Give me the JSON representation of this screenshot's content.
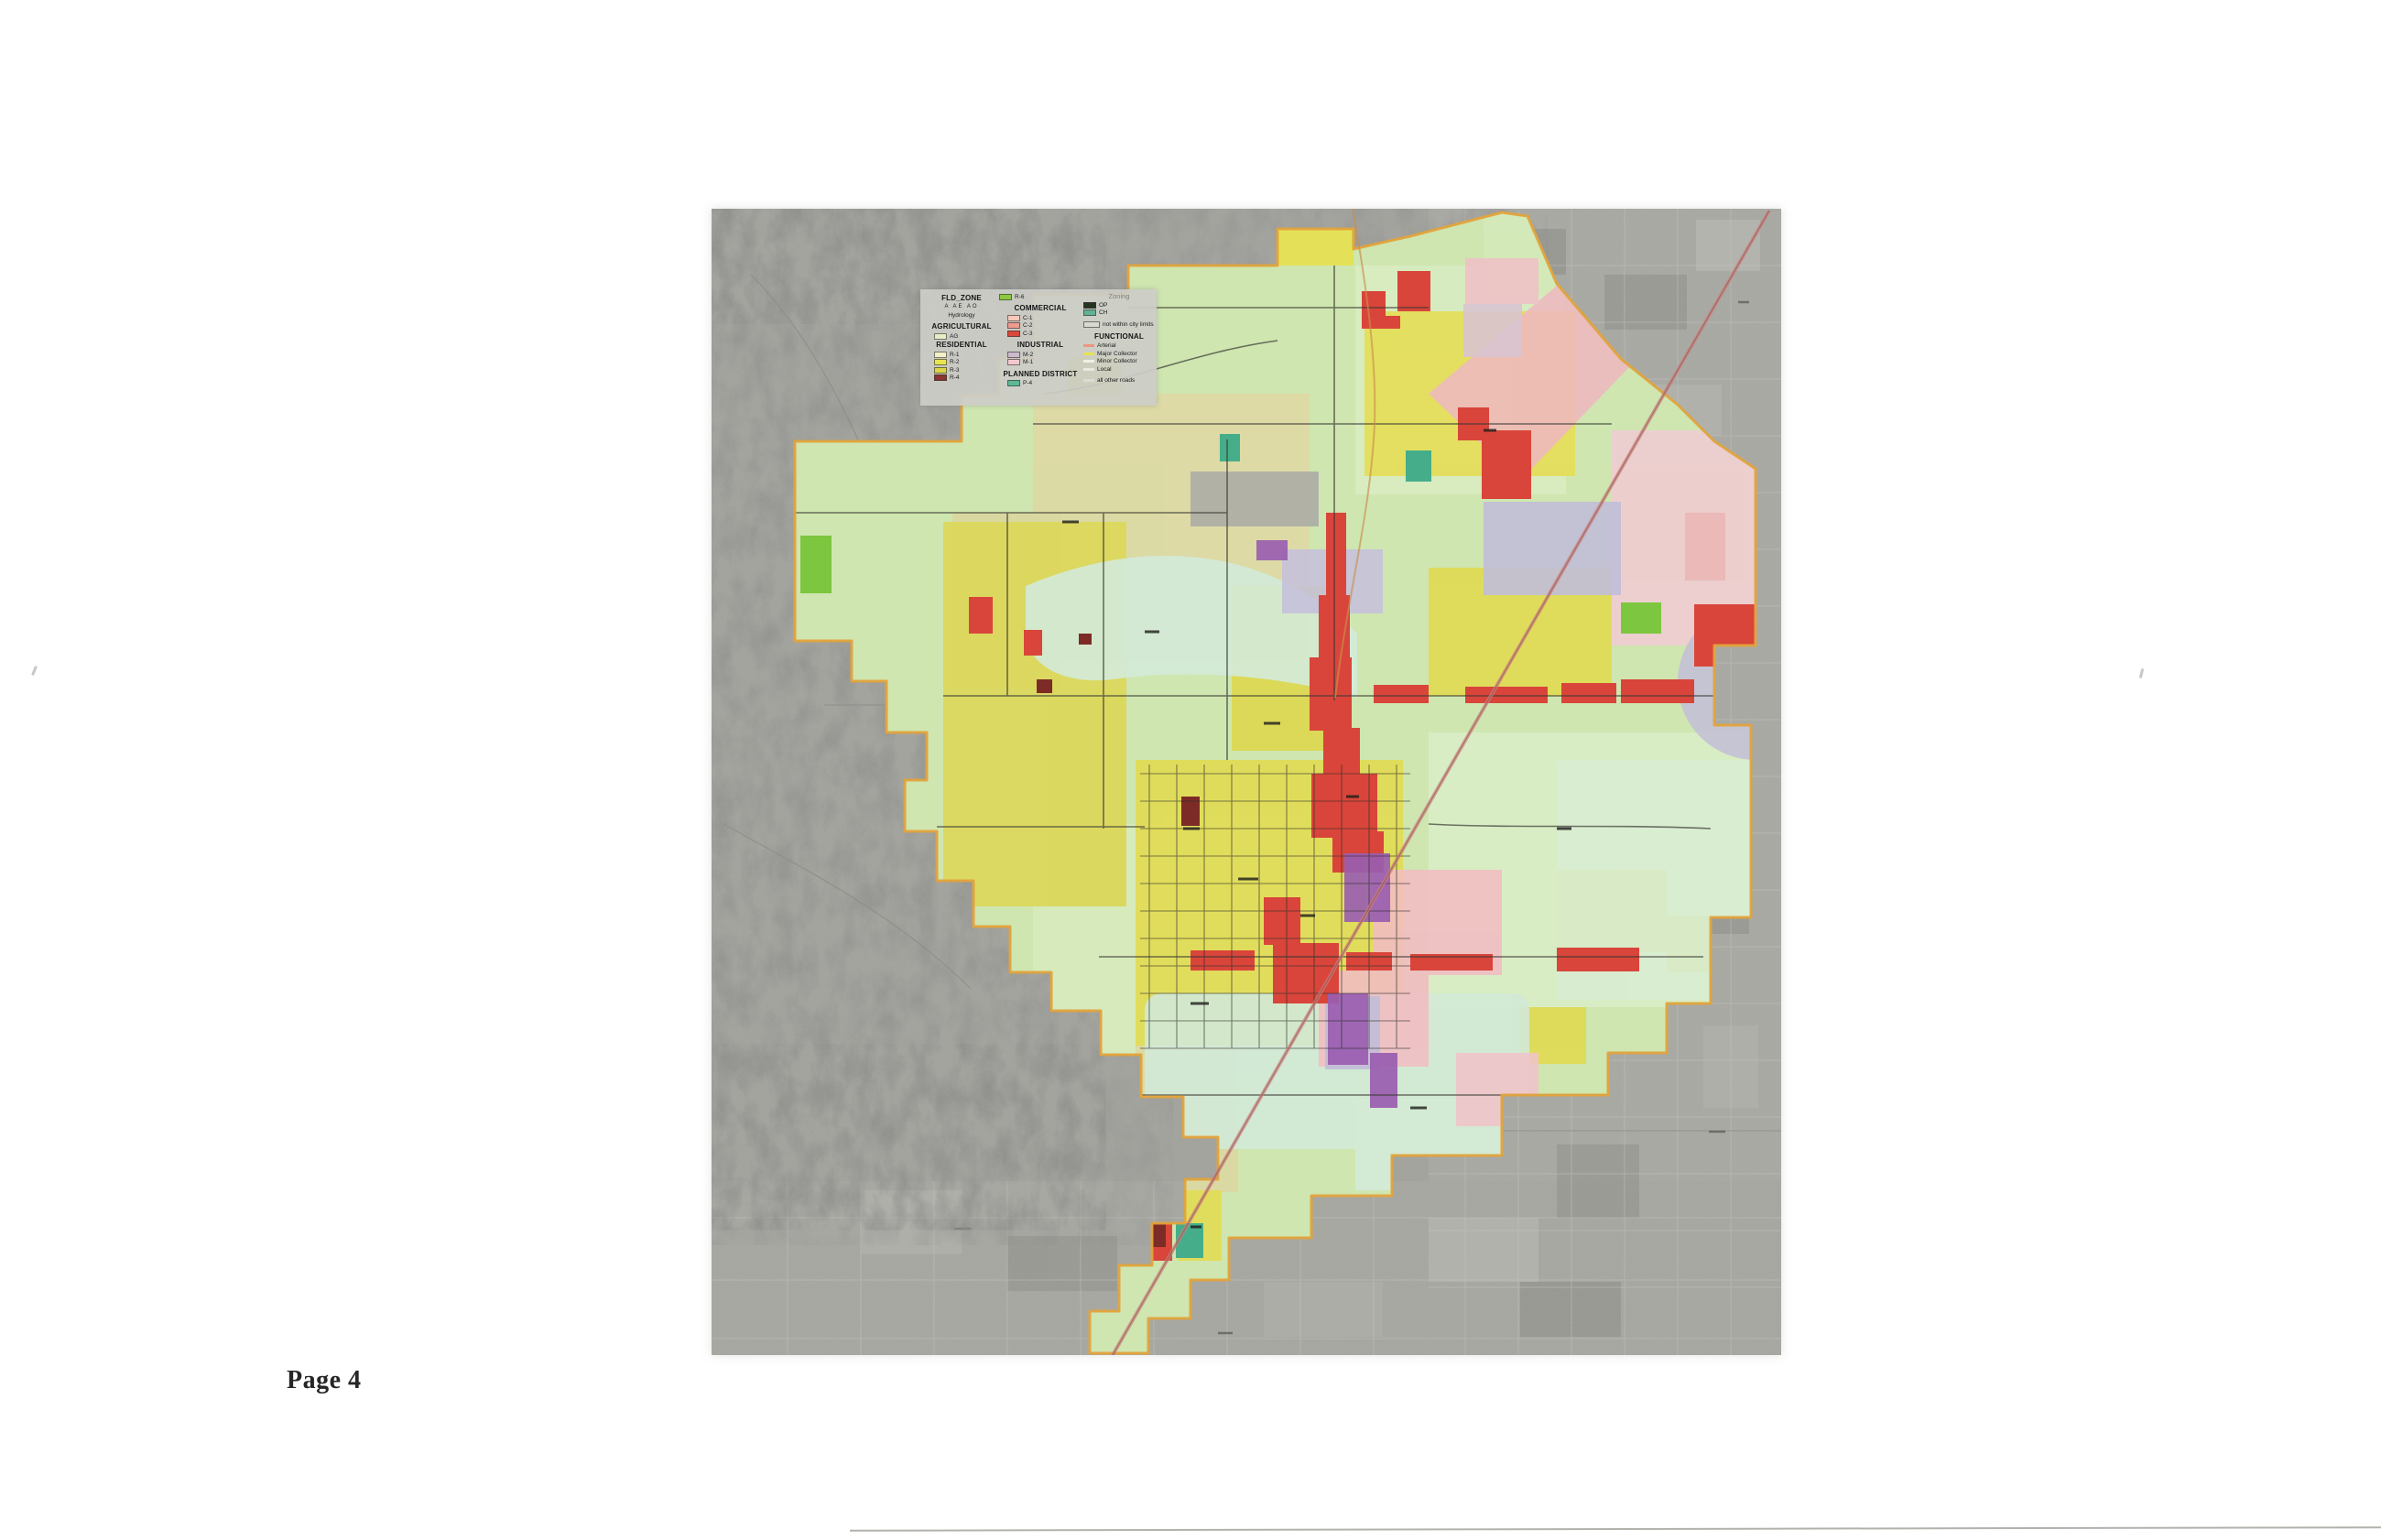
{
  "page": {
    "label": "Page 4"
  },
  "map": {
    "description": "City zoning districts over grayscale aerial photograph"
  },
  "legend": {
    "fld_zone": {
      "title": "FLD_ZONE",
      "codes": "A  AE  AO",
      "hydrology": "Hydrology"
    },
    "agricultural": {
      "title": "AGRICULTURAL",
      "code": "AG",
      "color": "#e7ecc6"
    },
    "residential": {
      "title": "RESIDENTIAL",
      "items": [
        {
          "code": "R-1",
          "color": "#f3efc8"
        },
        {
          "code": "R-2",
          "color": "#eae44f"
        },
        {
          "code": "R-3",
          "color": "#d9d348"
        },
        {
          "code": "R-4",
          "color": "#8a3330"
        }
      ]
    },
    "r6": {
      "code": "R-6",
      "color": "#8bc93e"
    },
    "commercial": {
      "title": "COMMERCIAL",
      "items": [
        {
          "code": "C-1",
          "color": "#f5cab8"
        },
        {
          "code": "C-2",
          "color": "#f09a90"
        },
        {
          "code": "C-3",
          "color": "#d9483b"
        }
      ]
    },
    "industrial": {
      "title": "INDUSTRIAL",
      "items": [
        {
          "code": "M-2",
          "color": "#ccbacd"
        },
        {
          "code": "M-1",
          "color": "#f3c8ce"
        }
      ]
    },
    "planned_district": {
      "title": "PLANNED DISTRICT",
      "items": [
        {
          "code": "P-4",
          "color": "#5eb898"
        }
      ]
    },
    "zoning": {
      "title": "Zoning",
      "items": [
        {
          "code": "OP",
          "color": "#26331f"
        },
        {
          "code": "CH",
          "color": "#63b195"
        },
        {
          "code": "not within city limits",
          "color": "#d9d9d2"
        }
      ]
    },
    "functional": {
      "title": "FUNCTIONAL",
      "items": [
        {
          "label": "Arterial",
          "color": "#ec9681"
        },
        {
          "label": "Major Collector",
          "color": "#e8e24f"
        },
        {
          "label": "Minor Collector",
          "color": "#f0f0e4"
        },
        {
          "label": "Local",
          "color": "#e9e9e1"
        },
        {
          "label": "all other roads",
          "color": "#dcdcd6"
        }
      ]
    }
  },
  "palette": {
    "aerial_gray": "#a3a39e",
    "hills_gray": "#8f8f8a",
    "city_base_green": "#cfe6b0",
    "city_boundary_orange": "#e2a33c",
    "floodway_seafoam": "#d3ead9",
    "residential_yellow": "#e2dc55",
    "commercial_red": "#d9453a",
    "industrial_pink": "#f2bdc3",
    "industrial_lavender": "#c1bdd8",
    "planned_teal": "#46ad8b",
    "r6_green": "#7dc63f",
    "r4_maroon": "#7c2b26",
    "highway_rose": "#c9807d"
  }
}
